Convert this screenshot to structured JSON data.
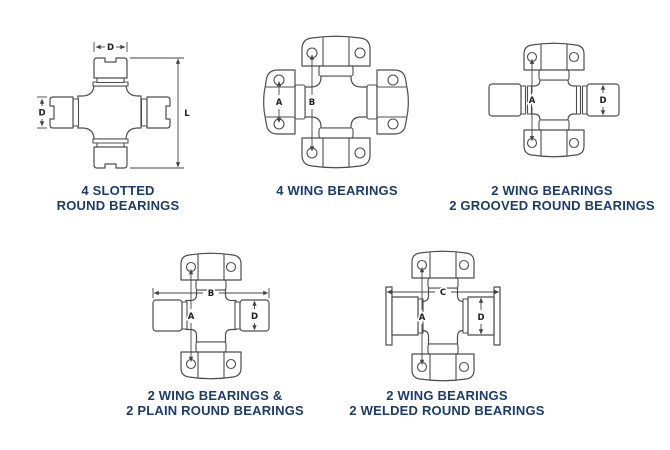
{
  "figure": {
    "description": "Universal joint bearing style diagrams",
    "colors": {
      "background": "#ffffff",
      "line": "#4d4d4d",
      "caption_text": "#1b3c6b",
      "dimension_text": "#1d1d1d"
    },
    "diagrams": [
      {
        "caption_line1": "4 SLOTTED",
        "caption_line2": "ROUND BEARINGS",
        "dim_labels": {
          "cap_width": "D",
          "cap_diameter": "D",
          "overall_length": "L"
        }
      },
      {
        "caption_line1": "4 WING BEARINGS",
        "caption_line2": "",
        "dim_labels": {
          "hole_span": "A",
          "cross_span": "B"
        }
      },
      {
        "caption_line1": "2 WING BEARINGS",
        "caption_line2": "2 GROOVED ROUND BEARINGS",
        "dim_labels": {
          "cross_span": "A",
          "bearing_diameter": "D"
        }
      },
      {
        "caption_line1": "2 WING BEARINGS &",
        "caption_line2": "2 PLAIN ROUND BEARINGS",
        "dim_labels": {
          "overall_width": "B",
          "cross_span": "A",
          "bearing_diameter": "D"
        }
      },
      {
        "caption_line1": "2 WING BEARINGS",
        "caption_line2": "2 WELDED ROUND BEARINGS",
        "dim_labels": {
          "overall_width": "C",
          "cross_span": "A",
          "bearing_diameter": "D"
        }
      }
    ]
  }
}
